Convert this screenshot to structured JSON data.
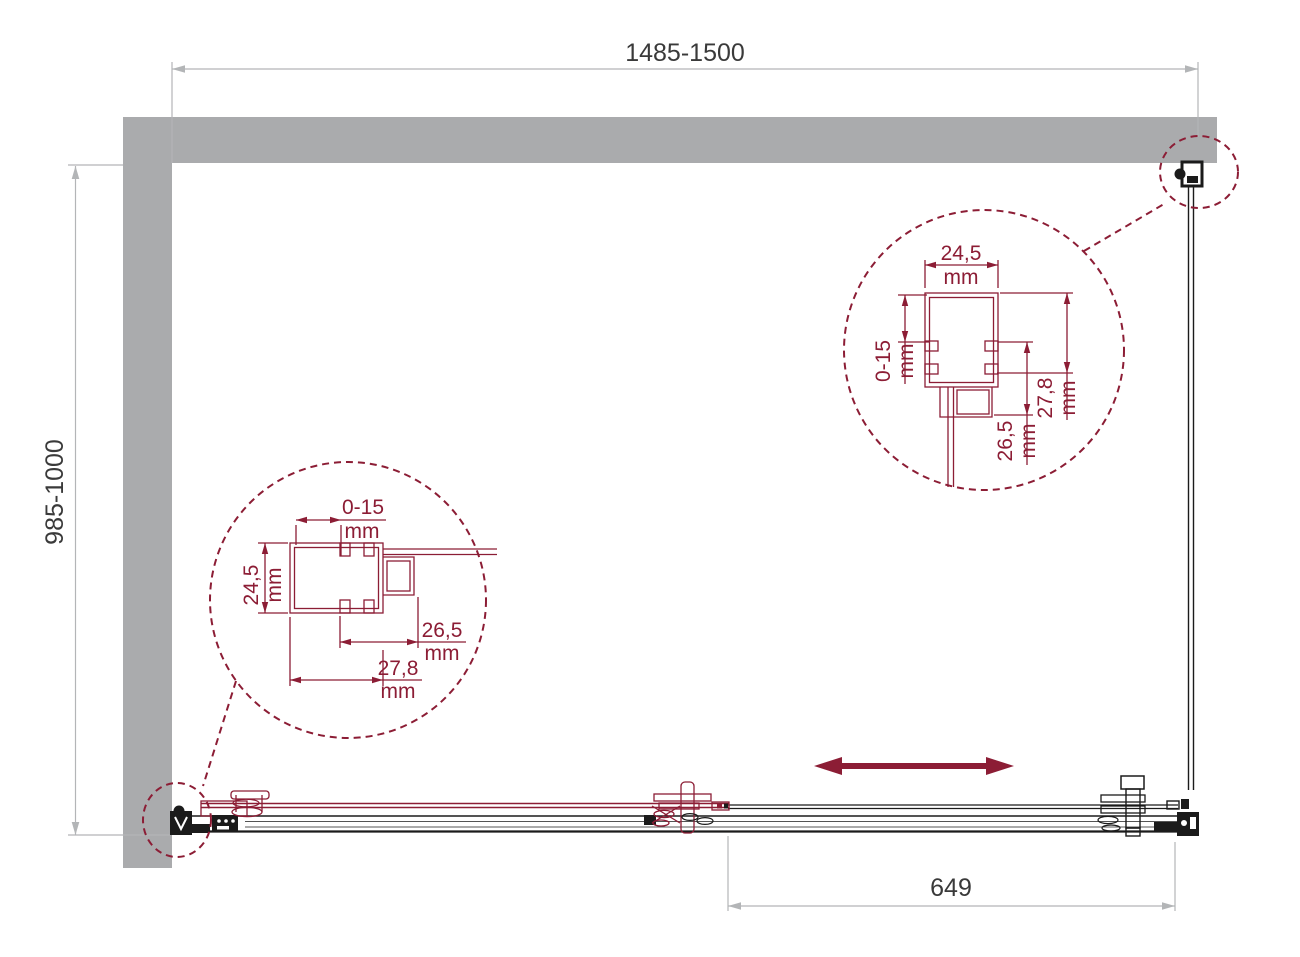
{
  "drawing": {
    "colors": {
      "wall_gray": "#aaabad",
      "accent_red": "#8c1d35",
      "dimension_line_gray": "#b3b5b7",
      "line_black": "#1b1b1b",
      "text_dark": "#3a3a3a"
    },
    "dimensions": {
      "width": {
        "value": "1485-1500"
      },
      "depth": {
        "value": "985-1000"
      },
      "opening": {
        "value": "649"
      }
    },
    "detail_left": {
      "adjust": {
        "value": "0-15",
        "unit": "mm"
      },
      "profile_width": {
        "value": "24,5",
        "unit": "mm"
      },
      "inner_depth": {
        "value": "26,5",
        "unit": "mm"
      },
      "outer_depth": {
        "value": "27,8",
        "unit": "mm"
      }
    },
    "detail_right": {
      "profile_width": {
        "value": "24,5",
        "unit": "mm"
      },
      "adjust": {
        "value": "0-15",
        "unit": "mm"
      },
      "inner_depth": {
        "value": "26,5",
        "unit": "mm"
      },
      "outer_depth": {
        "value": "27,8",
        "unit": "mm"
      }
    },
    "icons": {
      "slide_arrow": "double-headed-arrow"
    }
  }
}
